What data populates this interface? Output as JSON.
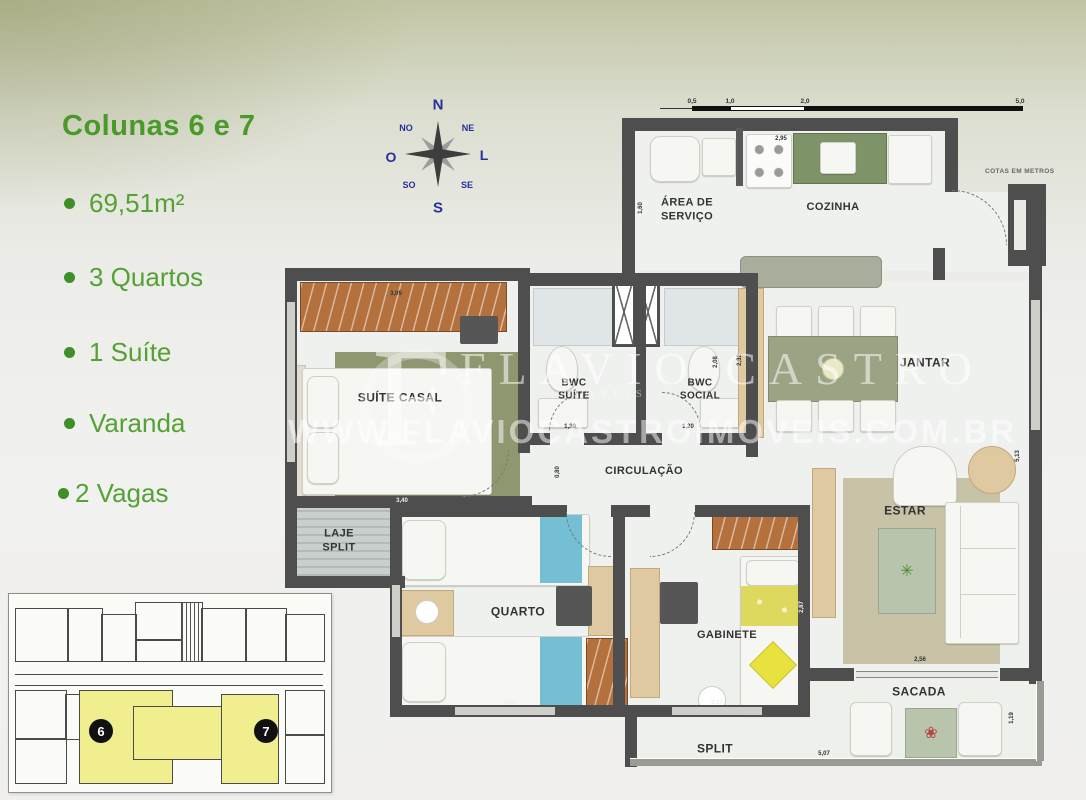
{
  "colors": {
    "title_green": "#4a9a2b",
    "item_green": "#54a136",
    "bullet_green": "#3e8f27",
    "compass_blue": "#26309b",
    "wall_gray": "#4e4e4e",
    "keyplan_highlight": "#f1ee8f"
  },
  "sidebar": {
    "title": "Colunas 6 e 7",
    "items": [
      "69,51m²",
      "3 Quartos",
      "1 Suíte",
      "Varanda",
      "2 Vagas"
    ]
  },
  "compass": {
    "n": "N",
    "ne": "NE",
    "l": "L",
    "se": "SE",
    "s": "S",
    "so": "SO",
    "o": "O",
    "no": "NO"
  },
  "scale": {
    "l1": "0,5",
    "l2": "1,0",
    "l3": "2,0",
    "l4": "5,0",
    "note": "COTAS EM METROS"
  },
  "watermark": {
    "monogram": "F",
    "name": "FLAVIO CASTRO",
    "sub": "IMÓVEIS",
    "url": "WWW.FLAVIOCASTROIMOVEIS.COM.BR"
  },
  "rooms": {
    "servico": "ÁREA DE\nSERVIÇO",
    "cozinha": "COZINHA",
    "suite": "SUÍTE CASAL",
    "bwc_suite": "BWC\nSUÍTE",
    "bwc_social": "BWC\nSOCIAL",
    "jantar": "JANTAR",
    "circulacao": "CIRCULAÇÃO",
    "laje": "LAJE\nSPLIT",
    "quarto": "QUARTO",
    "gabinete": "GABINETE",
    "estar": "ESTAR",
    "sacada": "SACADA",
    "split": "SPLIT"
  },
  "dims": {
    "servico": "1,60",
    "cozinha": "2,95",
    "guarda_roupa": "3,05",
    "suite": "3,40",
    "circulacao": "0,80",
    "bwc_suite_porta": "1,30",
    "bwc_social_porta": "1,20",
    "bwc_suite_prof": "2,08",
    "bwc_social_prof": "2,32",
    "parede_leste": "5,13",
    "quarto": "3,00",
    "gabinete": "2,17",
    "gabinete_prof": "2,87",
    "estar": "2,56",
    "sacada": "5,07",
    "sacada_prof": "1,19"
  },
  "keyplan": {
    "badge_6": "6",
    "badge_7": "7"
  }
}
